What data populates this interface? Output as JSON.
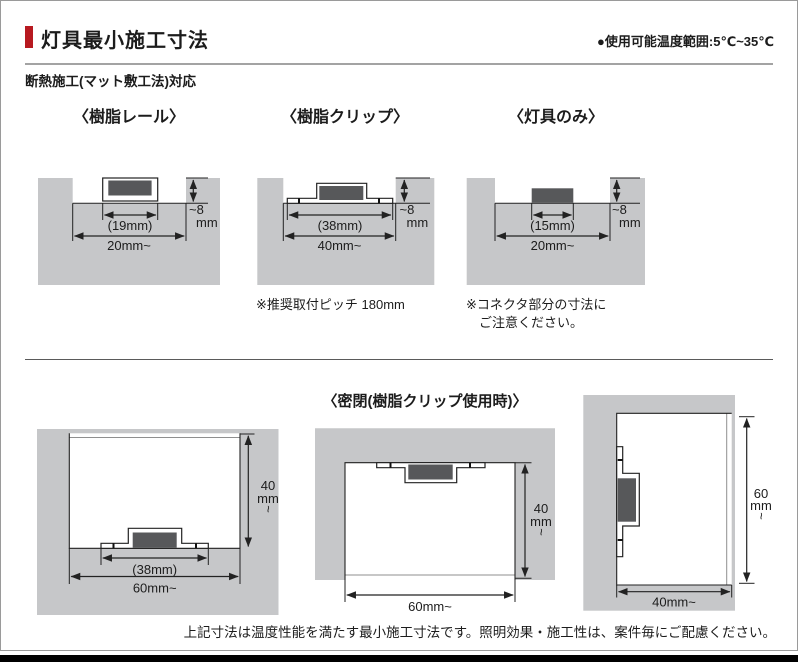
{
  "header": {
    "title": "灯具最小施工寸法",
    "temp_note": "●使用可能温度範囲:5℃~35℃",
    "subtitle": "断熱施工(マット敷工法)対応"
  },
  "colors": {
    "accent_red": "#b71920",
    "block_gray": "#c6c7c9",
    "fixture_dark": "#57585a"
  },
  "top_diagrams": [
    {
      "title": "〈樹脂レール〉",
      "fixture_width": "(19mm)",
      "opening_width": "20mm~",
      "depth_value": "~8",
      "depth_unit": "mm"
    },
    {
      "title": "〈樹脂クリップ〉",
      "fixture_width": "(38mm)",
      "opening_width": "40mm~",
      "depth_value": "~8",
      "depth_unit": "mm",
      "note": "※推奨取付ピッチ 180mm"
    },
    {
      "title": "〈灯具のみ〉",
      "fixture_width": "(15mm)",
      "opening_width": "20mm~",
      "depth_value": "~8",
      "depth_unit": "mm",
      "note_line1": "※コネクタ部分の寸法に",
      "note_line2": "ご注意ください。"
    }
  ],
  "sealed": {
    "title": "〈密閉(樹脂クリップ使用時)〉",
    "floor_mount": {
      "fixture_width": "(38mm)",
      "width": "60mm~",
      "height_value": "40",
      "height_unit": "mm",
      "height_tilde": "~"
    },
    "ceiling_mount": {
      "width": "60mm~",
      "height_value": "40",
      "height_unit": "mm",
      "height_tilde": "~"
    },
    "wall_mount": {
      "width": "40mm~",
      "height_value": "60",
      "height_unit": "mm",
      "height_tilde": "~"
    }
  },
  "footer_note": "上記寸法は温度性能を満たす最小施工寸法です。照明効果・施工性は、案件毎にご配慮ください。"
}
